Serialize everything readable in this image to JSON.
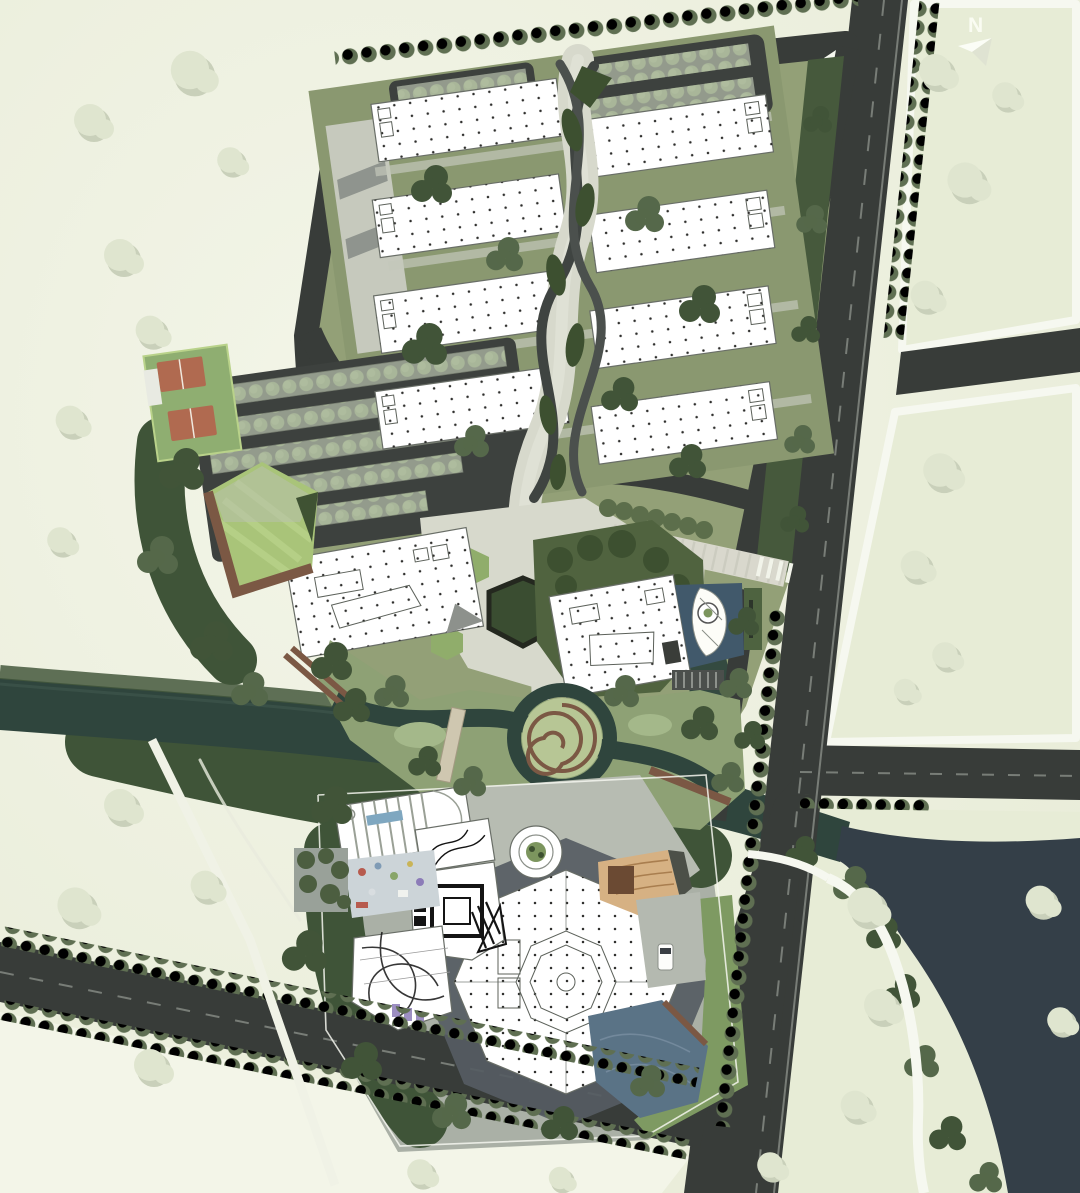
{
  "map": {
    "kind": "architectural-master-plan-aerial",
    "north_arrow_label": "N"
  },
  "colors": {
    "field": "#ecefdd",
    "fieldLight": "#f3f5e8",
    "parcel": "#e7ecd6",
    "road": "#383c39",
    "roadLine": "#8d938c",
    "white": "#f6f8f0",
    "water": "#2f453d",
    "lake": "#343f48",
    "pond": "#5a7386",
    "poolBlue": "#41596b",
    "marsh": "#8ea175",
    "lawn": "#90ad6b",
    "lawnBright": "#a9c479",
    "forest": "#3f5438",
    "treeDark": "#415438",
    "treeMid": "#55684a",
    "treeStreet": "#5f6f52",
    "canopy": "#c8d2bd",
    "paving": "#d7d9cc",
    "pavingMid": "#b4b9b0",
    "plazaDark": "#565c63",
    "asphaltLot": "#3d413e",
    "building": "#ffffff",
    "buildingLine": "#696e67",
    "deck": "#7b5844",
    "tan": "#d6b183",
    "courtRed": "#b06a50",
    "accentPurple": "#8c7cb8",
    "inkDetail": "#141414",
    "fadedTree": "#dfe5cf",
    "fadedTreeShadow": "#c9d0ba"
  },
  "features": [
    "perimeter-arterial-road",
    "campus-loop-road",
    "office-slab-buildings",
    "central-braided-pedestrian-spine",
    "parking-canopies",
    "sports-courts",
    "pentagon-lawn-park",
    "hexagon-plaza",
    "entrance-boulevard",
    "sail-pavilion-with-pool",
    "wetland-with-spiral-mound",
    "river",
    "lake",
    "octagon-hall",
    "round-pavilion",
    "amphitheater-deck",
    "playground",
    "forest-belt",
    "street-tree-rows",
    "north-arrow"
  ]
}
